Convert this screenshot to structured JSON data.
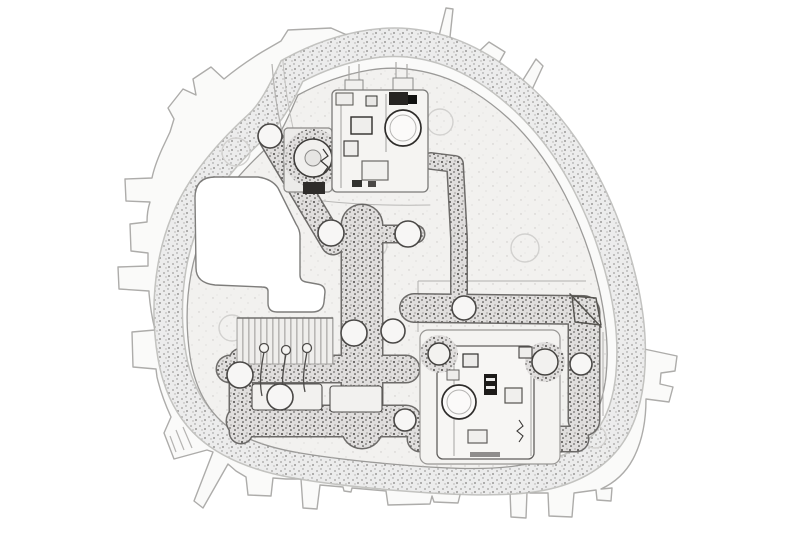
{
  "image": {
    "style": "pencil-sketch line drawing, white background",
    "subject": "Automotive rear lamp bulb holder carrier board, outline sketch",
    "background": "#ffffff"
  },
  "palette": {
    "paper": "#ffffff",
    "shell_fill": "#fafaf9",
    "shell_line": "#adacaa",
    "gasket_base": "#ececec",
    "gasket_dots": "#9a9998",
    "plate_fill": "#f2f1ef",
    "plate_line": "#9b9a98",
    "trace_base": "#e0dedd",
    "trace_dots": "#4c4a48",
    "detail_ink": "#2f2d2b",
    "faint_line": "#d2d1cf"
  },
  "parts": {
    "shell": "outer shell with mounting tabs and clips",
    "gasket": "stippled sealing gasket band",
    "plate": "inner carrier plate",
    "window": "lamp window cut-out",
    "socket_top": "upper bulb socket assembly",
    "socket_right": "lower right bulb socket assembly",
    "traces": "stippled conductor strips",
    "rivets": "contact rivets",
    "comb": "ribbed contact comb",
    "wires": "spring contact wires",
    "bosses": "molded boss circles"
  }
}
